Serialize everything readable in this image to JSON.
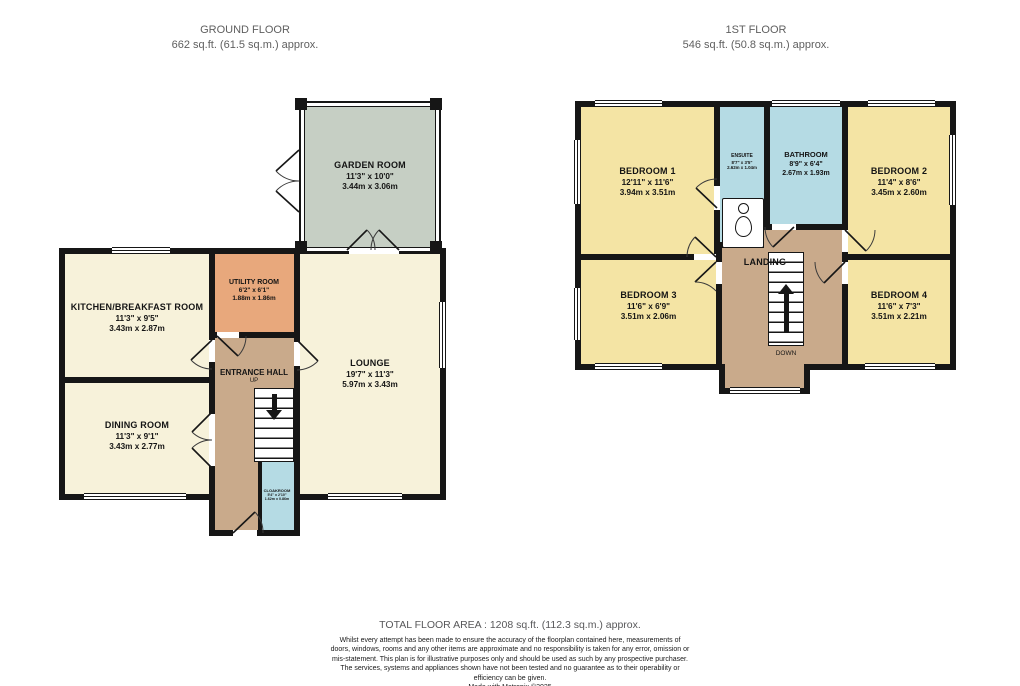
{
  "ground_floor": {
    "title": "GROUND FLOOR",
    "area": "662 sq.ft. (61.5 sq.m.) approx.",
    "rooms": {
      "garden_room": {
        "name": "GARDEN ROOM",
        "dims_ft": "11'3\" x 10'0\"",
        "dims_m": "3.44m x 3.06m"
      },
      "kitchen": {
        "name": "KITCHEN/BREAKFAST ROOM",
        "dims_ft": "11'3\" x 9'5\"",
        "dims_m": "3.43m x 2.87m"
      },
      "utility": {
        "name": "UTILITY ROOM",
        "dims_ft": "6'2\" x 6'1\"",
        "dims_m": "1.88m x 1.86m"
      },
      "lounge": {
        "name": "LOUNGE",
        "dims_ft": "19'7\" x 11'3\"",
        "dims_m": "5.97m x 3.43m"
      },
      "entrance_hall": {
        "name": "ENTRANCE HALL",
        "stair_label": "UP"
      },
      "dining": {
        "name": "DINING ROOM",
        "dims_ft": "11'3\" x 9'1\"",
        "dims_m": "3.43m x 2.77m"
      },
      "cloakroom": {
        "name": "CLOAKROOM",
        "dims_ft": "5'4\" x 2'10\"",
        "dims_m": "1.62m x 0.86m"
      }
    }
  },
  "first_floor": {
    "title": "1ST FLOOR",
    "area": "546 sq.ft. (50.8 sq.m.) approx.",
    "rooms": {
      "bedroom1": {
        "name": "BEDROOM 1",
        "dims_ft": "12'11\" x 11'6\"",
        "dims_m": "3.94m x 3.51m"
      },
      "ensuite": {
        "name": "ENSUITE",
        "dims_ft": "8'7\" x 3'5\"",
        "dims_m": "2.62m x 1.04m"
      },
      "bathroom": {
        "name": "BATHROOM",
        "dims_ft": "8'9\" x 6'4\"",
        "dims_m": "2.67m x 1.93m"
      },
      "bedroom2": {
        "name": "BEDROOM 2",
        "dims_ft": "11'4\" x 8'6\"",
        "dims_m": "3.45m x 2.60m"
      },
      "bedroom3": {
        "name": "BEDROOM 3",
        "dims_ft": "11'6\" x 6'9\"",
        "dims_m": "3.51m x 2.06m"
      },
      "landing": {
        "name": "LANDING",
        "stair_label": "DOWN"
      },
      "bedroom4": {
        "name": "BEDROOM 4",
        "dims_ft": "11'6\" x 7'3\"",
        "dims_m": "3.51m x 2.21m"
      }
    }
  },
  "footer": {
    "total_area": "TOTAL FLOOR AREA : 1208 sq.ft. (112.3 sq.m.) approx.",
    "disclaimer": "Whilst every attempt has been made to ensure the accuracy of the floorplan contained here, measurements of doors, windows, rooms and any other items are approximate and no responsibility is taken for any error, omission or mis-statement. This plan is for illustrative purposes only and should be used as such by any prospective purchaser. The services, systems and appliances shown have not been tested and no guarantee as to their operability or efficiency can be given.",
    "credit": "Made with Metropix ©2025"
  },
  "colors": {
    "wall": "#161616",
    "reception_cream": "#f7f2da",
    "bedroom_yellow": "#f4e4a4",
    "bathroom_blue": "#b5dbe4",
    "garden_sage": "#c6cfc4",
    "utility_orange": "#e8a87c",
    "hall_tan": "#c9aa8b"
  }
}
